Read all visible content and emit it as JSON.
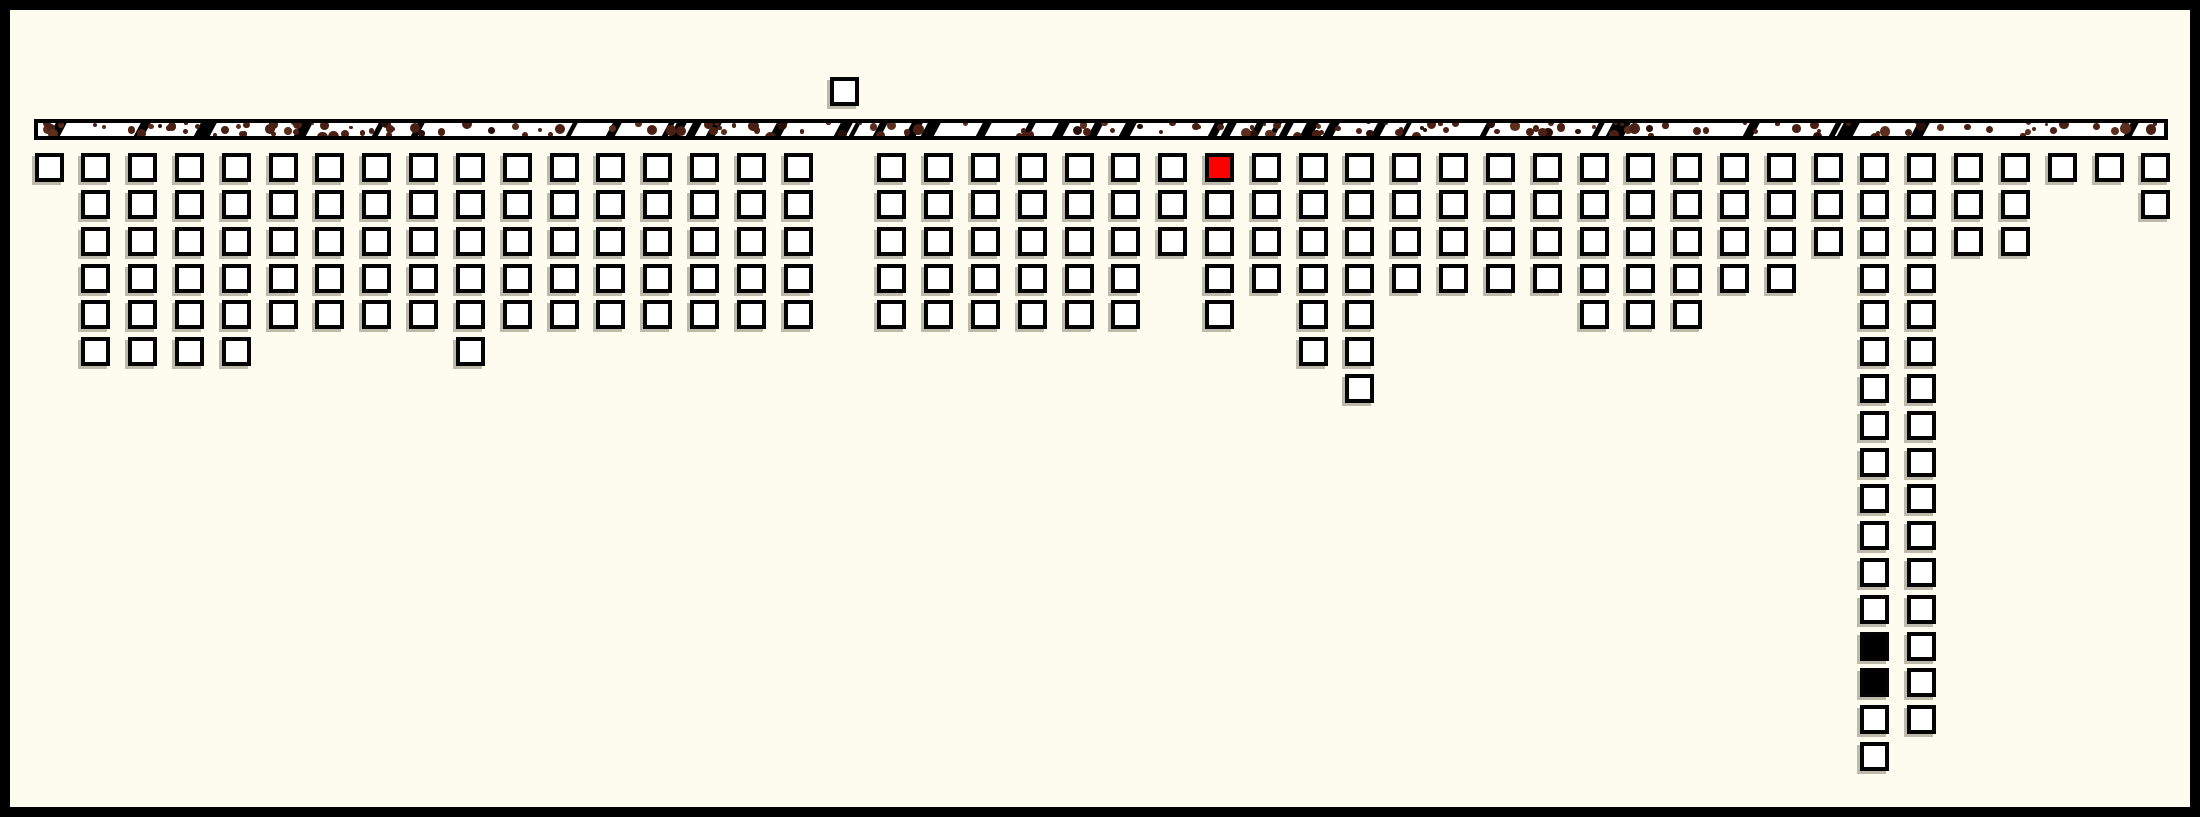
{
  "canvas": {
    "width": 2200,
    "height": 817,
    "background_color": "#FDFCEE",
    "frame_color": "#000000",
    "frame_thickness": 10
  },
  "ground_bar": {
    "x": 34,
    "y": 119,
    "width": 2134,
    "height": 21,
    "border_color": "#000000",
    "border_thickness": 4,
    "fill_color": "#FFFFFF",
    "texture": {
      "slash_color": "#000000",
      "dot_colors": [
        "#4A2015",
        "#5C2E1E",
        "#2A0F08"
      ],
      "slash_count": 52,
      "dot_count": 175,
      "seed": 11
    }
  },
  "grid": {
    "col_start_x": 49,
    "col_pitch": 46.82,
    "row_start_y": 167.7,
    "row_pitch": 36.8,
    "square_size": 29,
    "square_border_color": "#040404",
    "square_fill_color": "#FFFFFF",
    "red_color": "#FF0000",
    "black_color": "#000000",
    "above_bar_center_y": 91,
    "columns": [
      {
        "col": 1,
        "depth": 1
      },
      {
        "col": 2,
        "depth": 6
      },
      {
        "col": 3,
        "depth": 6
      },
      {
        "col": 4,
        "depth": 6
      },
      {
        "col": 5,
        "depth": 6
      },
      {
        "col": 6,
        "depth": 5
      },
      {
        "col": 7,
        "depth": 5
      },
      {
        "col": 8,
        "depth": 5
      },
      {
        "col": 9,
        "depth": 5
      },
      {
        "col": 10,
        "depth": 6
      },
      {
        "col": 11,
        "depth": 5
      },
      {
        "col": 12,
        "depth": 5
      },
      {
        "col": 13,
        "depth": 5
      },
      {
        "col": 14,
        "depth": 5
      },
      {
        "col": 15,
        "depth": 5
      },
      {
        "col": 16,
        "depth": 5
      },
      {
        "col": 17,
        "depth": 5
      },
      {
        "col": 18,
        "depth": 0,
        "above_bar": true
      },
      {
        "col": 19,
        "depth": 5
      },
      {
        "col": 20,
        "depth": 5
      },
      {
        "col": 21,
        "depth": 5
      },
      {
        "col": 22,
        "depth": 5
      },
      {
        "col": 23,
        "depth": 5
      },
      {
        "col": 24,
        "depth": 5
      },
      {
        "col": 25,
        "depth": 3
      },
      {
        "col": 26,
        "depth": 5,
        "specials": {
          "1": "red"
        }
      },
      {
        "col": 27,
        "depth": 4
      },
      {
        "col": 28,
        "depth": 6
      },
      {
        "col": 29,
        "depth": 7
      },
      {
        "col": 30,
        "depth": 4
      },
      {
        "col": 31,
        "depth": 4
      },
      {
        "col": 32,
        "depth": 4
      },
      {
        "col": 33,
        "depth": 4
      },
      {
        "col": 34,
        "depth": 5
      },
      {
        "col": 35,
        "depth": 5
      },
      {
        "col": 36,
        "depth": 5
      },
      {
        "col": 37,
        "depth": 4
      },
      {
        "col": 38,
        "depth": 4
      },
      {
        "col": 39,
        "depth": 3
      },
      {
        "col": 40,
        "depth": 17,
        "specials": {
          "14": "black",
          "15": "black"
        }
      },
      {
        "col": 41,
        "depth": 16
      },
      {
        "col": 42,
        "depth": 3
      },
      {
        "col": 43,
        "depth": 3
      },
      {
        "col": 44,
        "depth": 1
      },
      {
        "col": 45,
        "depth": 1
      },
      {
        "col": 46,
        "depth": 2
      }
    ]
  }
}
